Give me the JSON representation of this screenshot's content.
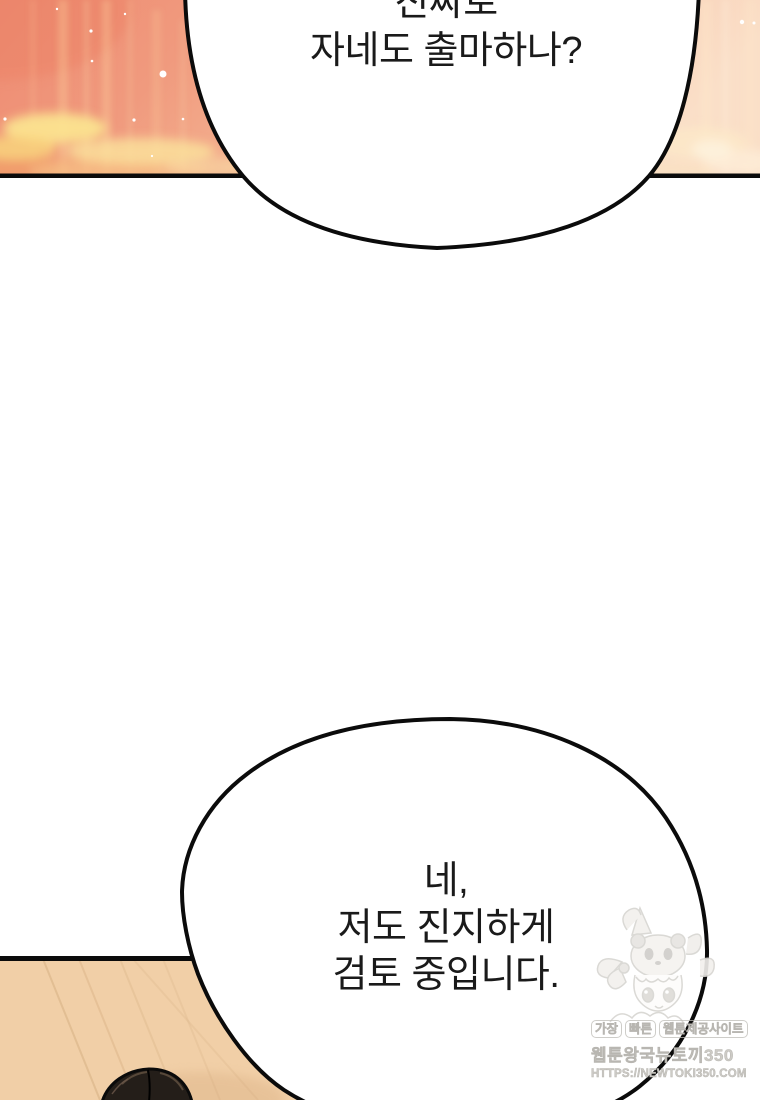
{
  "comic": {
    "bubble_top": {
      "lines": [
        "진짜로",
        "자네도 출마하나?"
      ]
    },
    "bubble_bottom": {
      "lines": [
        "네,",
        "저도 진지하게",
        "검토 중입니다."
      ]
    }
  },
  "watermark": {
    "site_tagline_words": [
      "가장",
      "빠른",
      "웹툰제공사이트"
    ],
    "site_name": "웹툰왕국뉴토끼350",
    "site_url": "HTTPS://NEWTOKI350.COM",
    "mascot": "chibi-girl-panda-hood"
  },
  "colors": {
    "text_color": "#1a1a1a",
    "ink": "#0b0b0b",
    "bubble_fill": "#ffffff",
    "sky_left": "#ee8b72",
    "sky_mid": "#f5b795",
    "sky_right": "#fadfc8",
    "cloud_yellow": "#fbe38f",
    "wall_tan": "#f1cfa7",
    "wall_grain": "#dcb68a",
    "hair_dark": "#241e19",
    "hair_highlight": "#5d4c3d",
    "watermark_gray": "#cdcbc6"
  }
}
